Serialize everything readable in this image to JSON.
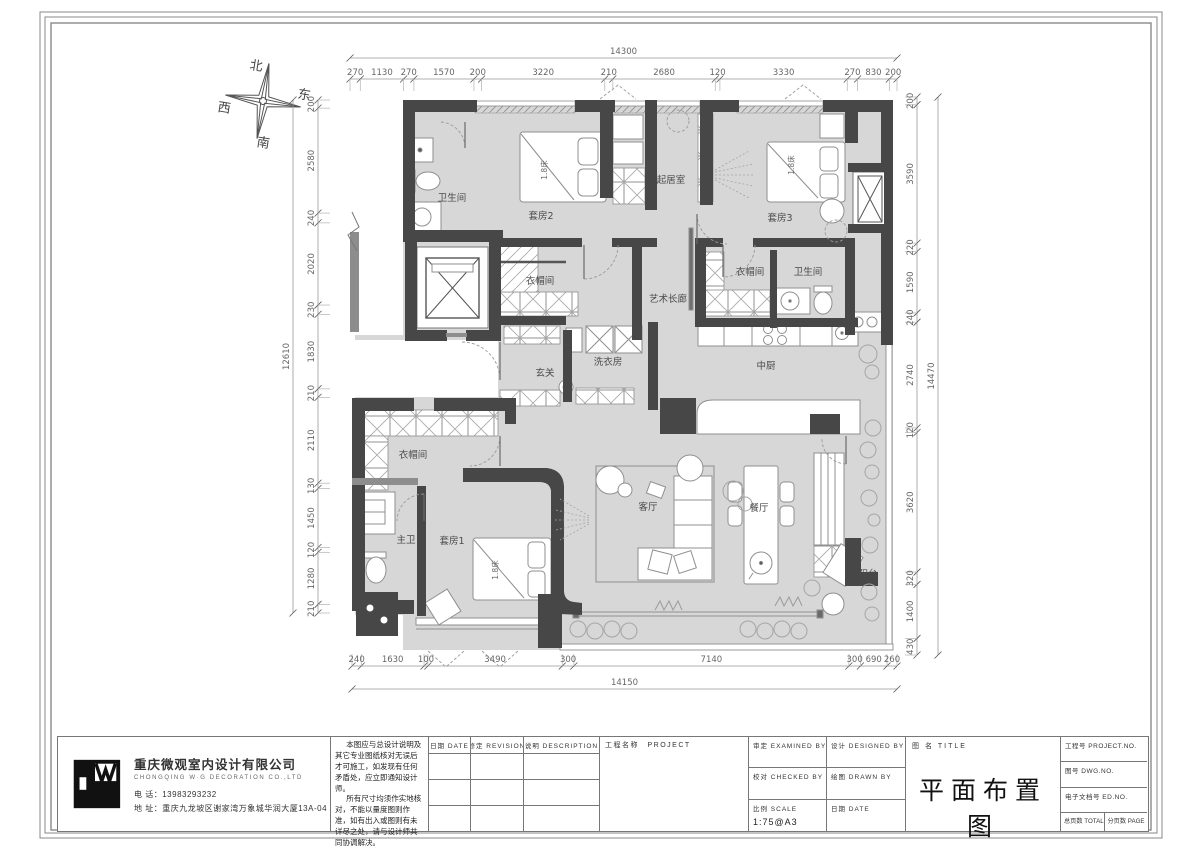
{
  "compass": {
    "north": "北",
    "south": "南",
    "east": "东",
    "west": "西"
  },
  "plan": {
    "rooms": [
      {
        "id": "bath-top",
        "label": "卫生间"
      },
      {
        "id": "suite2",
        "label": "套房2"
      },
      {
        "id": "closet-top",
        "label": "衣帽间"
      },
      {
        "id": "living-upper",
        "label": "起居室"
      },
      {
        "id": "suite3",
        "label": "套房3"
      },
      {
        "id": "closet-right",
        "label": "衣帽间"
      },
      {
        "id": "bath-right",
        "label": "卫生间"
      },
      {
        "id": "art-corridor",
        "label": "艺术长廊"
      },
      {
        "id": "laundry",
        "label": "洗衣房"
      },
      {
        "id": "foyer",
        "label": "玄关"
      },
      {
        "id": "kitchen",
        "label": "中厨"
      },
      {
        "id": "closet-bottom",
        "label": "衣帽间"
      },
      {
        "id": "master-bath",
        "label": "主卫"
      },
      {
        "id": "suite1",
        "label": "套房1"
      },
      {
        "id": "living-room",
        "label": "客厅"
      },
      {
        "id": "dining",
        "label": "餐厅"
      },
      {
        "id": "balcony",
        "label": "阳台"
      }
    ],
    "bed_labels": [
      {
        "label": "1.8床"
      },
      {
        "label": "1.8床"
      },
      {
        "label": "1.8床"
      }
    ]
  },
  "dimensions": {
    "top": {
      "total": "14300",
      "segments": [
        "270",
        "1130",
        "270",
        "1570",
        "200",
        "3220",
        "210",
        "2680",
        "120",
        "3330",
        "270",
        "830",
        "200"
      ]
    },
    "bottom": {
      "total": "14150",
      "segments": [
        "240",
        "1630",
        "100",
        "3490",
        "300",
        "7140",
        "300",
        "690",
        "260"
      ]
    },
    "left": {
      "total": "12610",
      "segments": [
        "200",
        "2580",
        "240",
        "2020",
        "230",
        "1830",
        "210",
        "2110",
        "130",
        "1450",
        "120",
        "1280",
        "210"
      ]
    },
    "right": {
      "total": "14470",
      "segments": [
        "200",
        "3590",
        "220",
        "1590",
        "240",
        "2740",
        "120",
        "3620",
        "320",
        "1400",
        "430"
      ]
    }
  },
  "title_block": {
    "company": {
      "name": "重庆微观室内设计有限公司",
      "name_en": "CHONGQING W·G DECORATION CO.,LTD",
      "phone_label": "电 话：",
      "phone": "13983293232",
      "address_label": "地 址：",
      "address": "重庆九龙坡区谢家湾万象城华润大厦13A-04"
    },
    "notes": [
      "本图应与总设计说明及其它专业图纸核对无误后才可施工，如发现有任何矛盾处，应立即通知设计师。",
      "所有尺寸均须作实地核对，不能以量度图则作准，如有出入或图则有未详尽之处，请与设计师共同协调解决。"
    ],
    "rev_table": {
      "col_date": "日期 DATE",
      "col_rev": "修定 REVISION",
      "col_desc": "说明 DESCRIPTION",
      "col_project": "工程名称　PROJECT"
    },
    "approval": {
      "examined": "审定 EXAMINED BY",
      "designed": "设计 DESIGNED BY",
      "checked": "校对 CHECKED BY",
      "drawn": "绘图 DRAWN BY",
      "scale_label": "比例 SCALE",
      "scale_value": "1:75@A3",
      "date_label": "日期 DATE"
    },
    "title": {
      "label": "图 名 TITLE",
      "value": "平面布置图"
    },
    "numbers": {
      "project_no": "工程号 PROJECT.NO.",
      "dwg_no": "图号 DWG.NO.",
      "ed_no": "电子文档号 ED.NO.",
      "total_page": "总页数 TOTAL PAGE",
      "page": "分页数 PAGE"
    }
  },
  "colors": {
    "wall": "#474747",
    "floor": "#d7d7d7",
    "accent_grey": "#8d8d8d"
  }
}
